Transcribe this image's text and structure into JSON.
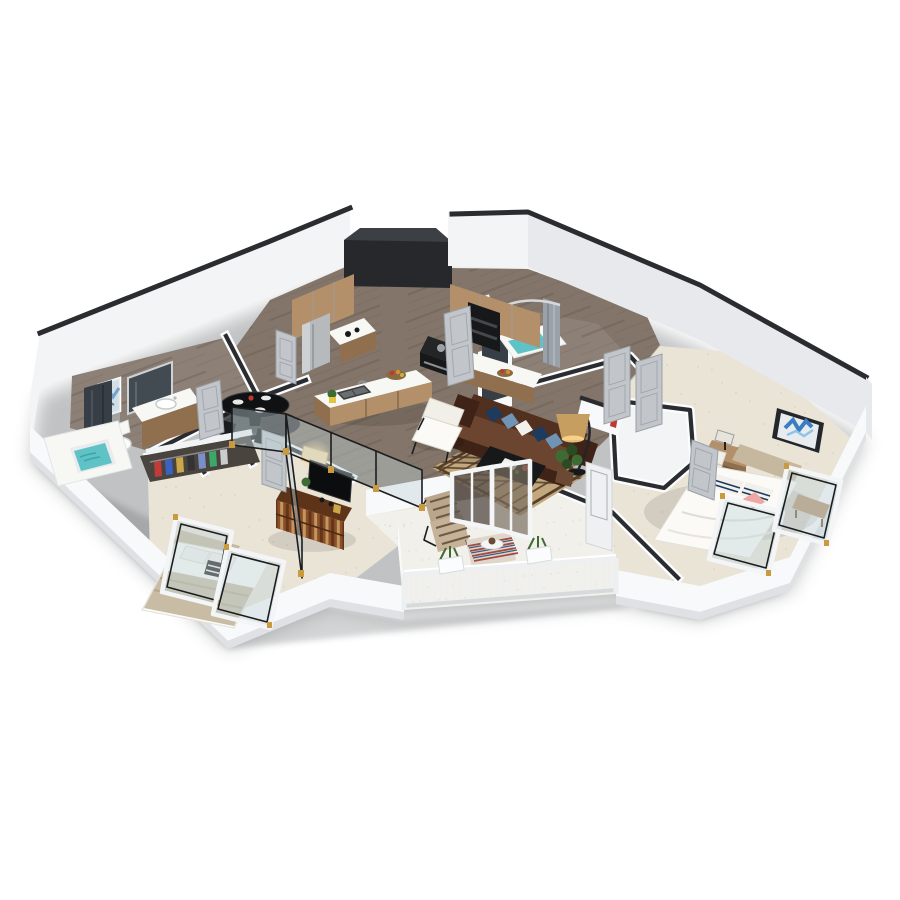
{
  "scene": {
    "description": "3D isometric floor-plan rendering of a two-bedroom, two-bath apartment with balcony on a white background",
    "view": "isometric cutaway, walls white with dark top caps",
    "background": "#ffffff"
  },
  "rooms": [
    {
      "id": "kitchen",
      "label": "Kitchen",
      "floor": "dark wood plank",
      "items": [
        "wood-upper-cabinets",
        "stainless-refrigerator",
        "coffee-counter",
        "wall-oven-stack",
        "range-cooktop",
        "quartz-counter",
        "kitchen-island",
        "double-sink",
        "faucet",
        "fruit-basket",
        "yellow-potted-herb",
        "dark-ceiling-soffit"
      ]
    },
    {
      "id": "dining-nook",
      "label": "Dining nook",
      "floor": "dark wood plank",
      "items": [
        "round-black-glass-table",
        "white-place-settings",
        "red-centerpiece",
        "dark-side-chairs"
      ]
    },
    {
      "id": "living-room",
      "label": "Living room",
      "floor": "dark wood plank",
      "items": [
        "brown-chesterfield-sofa",
        "navy-and-blue-throw-pillows",
        "white-lounge-chair",
        "black-coffee-table",
        "white-tray",
        "diamond-pattern-area-rug",
        "arc-floor-lamp",
        "potted-plant",
        "half-wall-shelf",
        "red-fire-extinguisher"
      ]
    },
    {
      "id": "bedroom-right",
      "label": "Bedroom 1",
      "floor": "cream carpet",
      "items": [
        "platform-bed-white-bedding",
        "tan-upholstered-headboard",
        "striped-pillows",
        "pink-accent-pillow",
        "writing-desk",
        "desk-lamp",
        "white-side-chair",
        "blue-abstract-wall-art",
        "wood-bench",
        "open-french-glass-doors",
        "walk-in-closet",
        "gray-closet-doors"
      ]
    },
    {
      "id": "bedroom-left",
      "label": "Bedroom 2",
      "floor": "cream carpet",
      "items": [
        "bed-tan-striped-duvet",
        "white-pillows",
        "black-white-cushion",
        "black-frame-glass-partition",
        "brass-hinges",
        "white-frame-glass-doors",
        "patterned-wood-dresser",
        "flat-screen-tv",
        "lit-table-lamp",
        "open-closet-with-clothes"
      ]
    },
    {
      "id": "bathroom-left",
      "label": "Bathroom 1",
      "floor": "gray wood",
      "items": [
        "soaking-tub-teal-water",
        "dark-marble-shower",
        "vanity-with-sink",
        "vanity-mirror",
        "toilet",
        "blue-abstract-art"
      ]
    },
    {
      "id": "bathroom-top",
      "label": "Bathroom 2",
      "floor": "gray wood",
      "items": [
        "tub-shower-teal-floor",
        "gray-shower-curtain",
        "curved-curtain-rod",
        "dark-vanity-panel"
      ]
    },
    {
      "id": "balcony",
      "label": "Balcony",
      "floor": "white concrete",
      "items": [
        "white-picket-railing",
        "rail-planter-boxes",
        "slatted-lounge-chair",
        "striped-outdoor-rug",
        "round-side-table",
        "sliding-glass-door",
        "open-patio-door"
      ]
    },
    {
      "id": "hallway",
      "label": "Hall",
      "floor": "wood to carpet transition",
      "items": [
        "gray-panel-doors"
      ]
    }
  ],
  "palette": {
    "bg": "#ffffff",
    "shadow": "#63676b",
    "cap": "#2a2c2f",
    "wall": "#f3f4f6",
    "wallShade": "#e7e9ec",
    "wallFront": "#f8f9fa",
    "wallEdge": "#dfe1e4",
    "soffit": "#26282b",
    "soffitTop": "#3c4044",
    "wood": "#837569",
    "woodStreak": "#5f5349",
    "bathWood": "#8d8076",
    "carpet": "#eae4d7",
    "carpetDot": "#d6cfbf",
    "patio": "#f1f0ea",
    "patioDot": "#dddbd2",
    "cabWood": "#b3906a",
    "cabWoodDark": "#8f6f4e",
    "counter": "#f7f7f4",
    "steel": "#b6babd",
    "black": "#17181a",
    "appliance": "#232527",
    "sofa": "#52301f",
    "sofaDark": "#3e2316",
    "sofaLight": "#6b4530",
    "navy": "#1d3a5f",
    "blueLt": "#6f94b5",
    "pillowWhite": "#f2f0ea",
    "chairWhite": "#f1efe7",
    "frameDark": "#1c1d1f",
    "rug": "#c3a87d",
    "rugDark": "#553f2b",
    "lampShade": "#c59e60",
    "lampGlow": "#ffd98f",
    "plant": "#3e6b33",
    "plantDark": "#2b4c23",
    "pot": "#6b4a33",
    "headboard": "#c6b89e",
    "mattress": "#fbfaf7",
    "duvet": "#c8bca4",
    "pink": "#efa7a1",
    "teal": "#5fc2c6",
    "tealDark": "#3da5aa",
    "marble": "#383e45",
    "artBlue": "#3b7ec2",
    "artBlue2": "#8fc3e8",
    "artFrame": "#23272b",
    "door": "#c2c6cb",
    "doorEdge": "#9aa0a7",
    "doorFrame": "#e9ebee",
    "glass": "#c2d3da",
    "glassFrame": "#f4f5f7",
    "rail": "#edeff1",
    "railShade": "#d7dadd",
    "dresser": "#8a4e2a",
    "dresserDark": "#5e3418",
    "dresserLight": "#c99f63",
    "tv": "#0c0d0e",
    "gold": "#c99a3f",
    "red": "#bf3a2e",
    "curtain": "#9aa1a8"
  }
}
